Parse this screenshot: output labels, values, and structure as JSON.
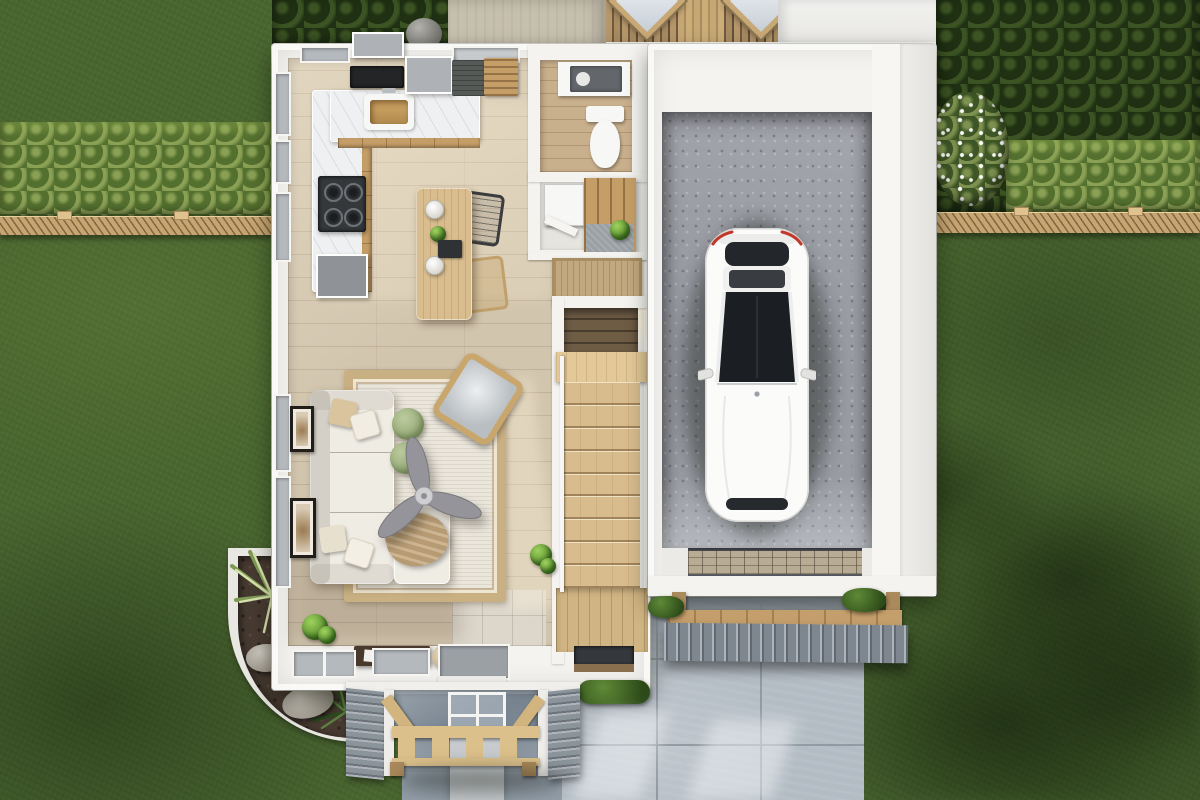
{
  "scene": {
    "type": "3d-floor-plan-render",
    "view": "top-down-overhead",
    "description": "Photoreal overhead render of a house first floor with attached single garage, white car, front porch with wood truss, paver driveway, lawn, hedges and privacy fence"
  },
  "rooms": [
    {
      "id": "kitchen",
      "label": "Kitchen"
    },
    {
      "id": "dining-area",
      "label": "Dining Area"
    },
    {
      "id": "living-room",
      "label": "Living Room"
    },
    {
      "id": "powder-room",
      "label": "Powder Room"
    },
    {
      "id": "mudroom",
      "label": "Mudroom"
    },
    {
      "id": "staircase",
      "label": "Staircase"
    },
    {
      "id": "entry",
      "label": "Entry"
    },
    {
      "id": "garage",
      "label": "Garage"
    },
    {
      "id": "front-porch",
      "label": "Front Porch"
    }
  ],
  "exterior": [
    {
      "id": "driveway",
      "label": "Paver Driveway"
    },
    {
      "id": "front-walkway",
      "label": "Front Walkway"
    },
    {
      "id": "lawn",
      "label": "Lawn"
    },
    {
      "id": "hedgerow",
      "label": "Hedgerow"
    },
    {
      "id": "privacy-fence",
      "label": "Privacy Fence"
    },
    {
      "id": "landscape-bed",
      "label": "Landscape Bed"
    },
    {
      "id": "garage-awning",
      "label": "Garage Door Awning"
    },
    {
      "id": "rear-deck",
      "label": "Rear Deck"
    },
    {
      "id": "back-patio",
      "label": "Back Patio"
    }
  ],
  "furniture": [
    "l-shaped-sofa",
    "throw-pillows",
    "round-ottomans",
    "ceiling-fan",
    "accent-armchair",
    "area-rug",
    "wall-art-frames",
    "console-table",
    "dining-table",
    "pendant-lights",
    "wire-chairs",
    "kitchen-counter",
    "farmhouse-sink",
    "gas-cooktop",
    "wall-oven",
    "refrigerator",
    "range-hood",
    "toilet",
    "vanity",
    "washer",
    "mudroom-bench",
    "doormat",
    "potted-plants",
    "white-car"
  ],
  "counts": {
    "stair_treads": 9,
    "ottomans": 2,
    "throw_pillows": 4,
    "wall_frames": 2,
    "pendant_lights": 2,
    "skylights": 2,
    "fan_blades": 3,
    "dining_chairs": 2
  },
  "joints": {
    "driveway_x": [
      98,
      202
    ],
    "driveway_y": [
      66,
      152
    ],
    "walkway_y": [
      44,
      88
    ]
  },
  "palette": {
    "grass": "#4a6630",
    "hedge": "#1f3013",
    "shrub_light": "#8aa055",
    "fence_wood": "#c7a572",
    "patio_concrete": "#c6bfae",
    "deck_wood": "#b5976a",
    "wall_white": "#f4f3f0",
    "floor_wood": "#d2c5ae",
    "tile": "#dcd6cb",
    "counter_marble": "#eef0f1",
    "cabinet_wood": "#c59e67",
    "island_wood": "#d9bd8e",
    "appliance_gray": "#aeb2b6",
    "window_gray": "#b4b9bd",
    "mat_dark": "#565a57",
    "doormat_tan": "#c2a87e",
    "toilet_white": "#f7f7f5",
    "stair_wood": "#d8bc8e",
    "stair_dark": "#6e5c45",
    "rug_field": "#eae6dc",
    "rug_border": "#c9b083",
    "sofa_white": "#efece4",
    "throw_tan": "#b79b74",
    "pouf_green": "#8fa470",
    "plant_green": "#4f8426",
    "mulch": "#473a31",
    "garage_floor": "#9a9ca4",
    "driveway": "#b3bcc4",
    "driveway_joint": "#8b949c",
    "walkway": "#939ea9",
    "walkway_strip": "#c7cbce",
    "shingle_gray": "#8b939b",
    "truss_wood": "#dcc08b",
    "awning_gray": "#7e8790",
    "car_white": "#fbfbfa",
    "glass_dark": "#1e2124"
  }
}
